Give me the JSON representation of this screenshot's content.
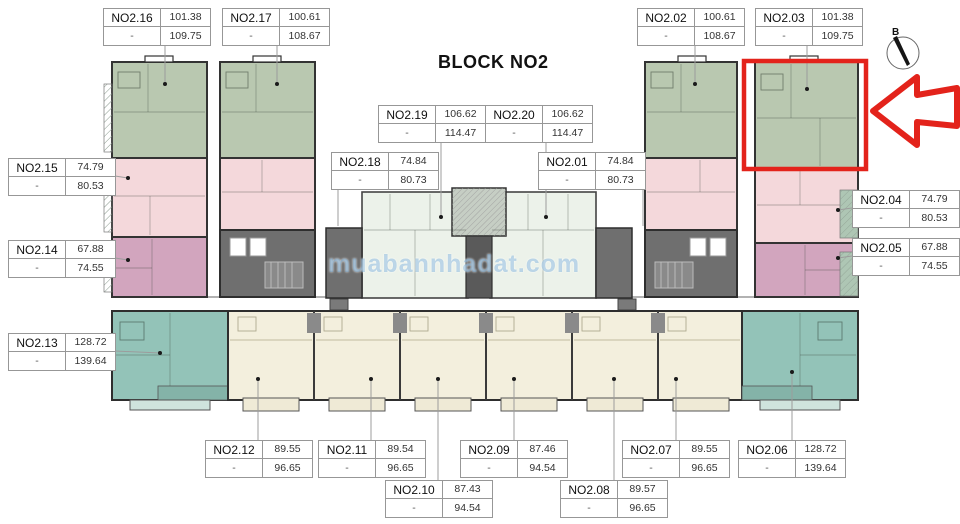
{
  "title": "BLOCK NO2",
  "compass": {
    "label": "B"
  },
  "watermark": {
    "text": "muabannhadat.com"
  },
  "highlight": {
    "unit": "NO2.03",
    "arrow_direction": "left",
    "color": "#e3231b"
  },
  "colors": {
    "unit_green": "#b9c8b0",
    "unit_pink": "#f4d8db",
    "unit_mauve": "#d2a5be",
    "unit_teal": "#93c3b8",
    "unit_cream": "#f3efdd",
    "unit_pale": "#ecf2ea",
    "core_gray": "#6f6f6f",
    "wall": "#333333",
    "highlight_red": "#e3231b"
  },
  "units": [
    {
      "name": "NO2.16",
      "area1": "101.38",
      "dash": "-",
      "area2": "109.75"
    },
    {
      "name": "NO2.17",
      "area1": "100.61",
      "dash": "-",
      "area2": "108.67"
    },
    {
      "name": "NO2.02",
      "area1": "100.61",
      "dash": "-",
      "area2": "108.67"
    },
    {
      "name": "NO2.03",
      "area1": "101.38",
      "dash": "-",
      "area2": "109.75"
    },
    {
      "name": "NO2.19",
      "area1": "106.62",
      "dash": "-",
      "area2": "114.47"
    },
    {
      "name": "NO2.20",
      "area1": "106.62",
      "dash": "-",
      "area2": "114.47"
    },
    {
      "name": "NO2.18",
      "area1": "74.84",
      "dash": "-",
      "area2": "80.73"
    },
    {
      "name": "NO2.01",
      "area1": "74.84",
      "dash": "-",
      "area2": "80.73"
    },
    {
      "name": "NO2.15",
      "area1": "74.79",
      "dash": "-",
      "area2": "80.53"
    },
    {
      "name": "NO2.14",
      "area1": "67.88",
      "dash": "-",
      "area2": "74.55"
    },
    {
      "name": "NO2.13",
      "area1": "128.72",
      "dash": "-",
      "area2": "139.64"
    },
    {
      "name": "NO2.04",
      "area1": "74.79",
      "dash": "-",
      "area2": "80.53"
    },
    {
      "name": "NO2.05",
      "area1": "67.88",
      "dash": "-",
      "area2": "74.55"
    },
    {
      "name": "NO2.12",
      "area1": "89.55",
      "dash": "-",
      "area2": "96.65"
    },
    {
      "name": "NO2.11",
      "area1": "89.54",
      "dash": "-",
      "area2": "96.65"
    },
    {
      "name": "NO2.09",
      "area1": "87.46",
      "dash": "-",
      "area2": "94.54"
    },
    {
      "name": "NO2.07",
      "area1": "89.55",
      "dash": "-",
      "area2": "96.65"
    },
    {
      "name": "NO2.06",
      "area1": "128.72",
      "dash": "-",
      "area2": "139.64"
    },
    {
      "name": "NO2.10",
      "area1": "87.43",
      "dash": "-",
      "area2": "94.54"
    },
    {
      "name": "NO2.08",
      "area1": "89.57",
      "dash": "-",
      "area2": "96.65"
    }
  ]
}
